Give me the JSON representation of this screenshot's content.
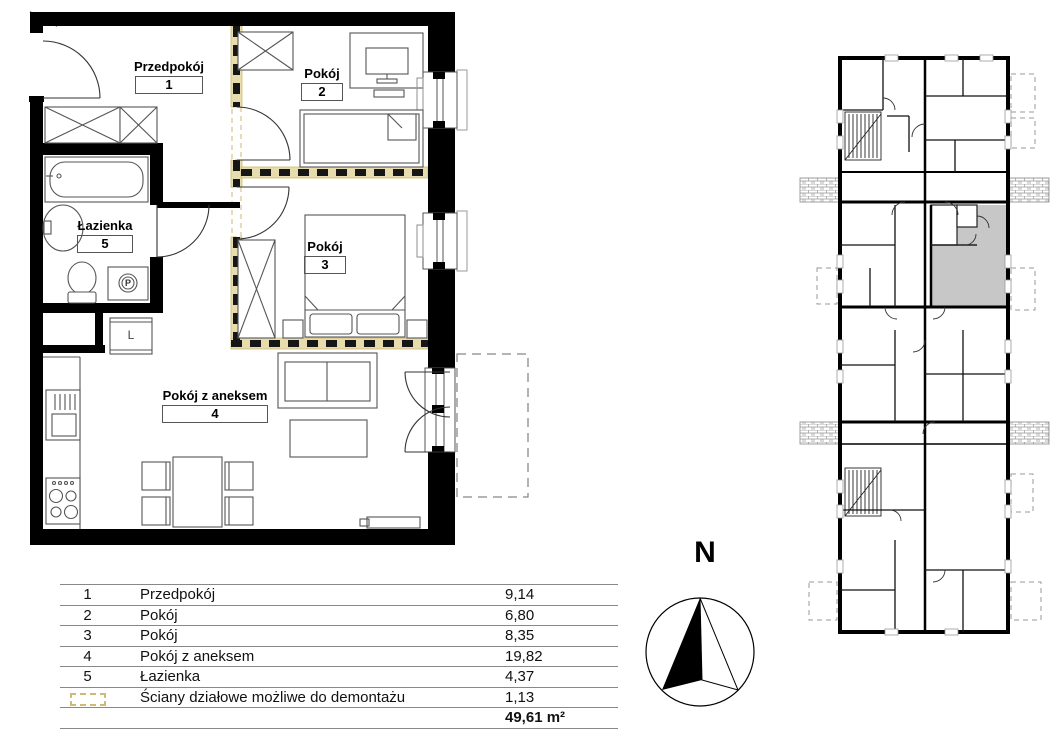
{
  "floor_plan": {
    "rooms": [
      {
        "id": "1",
        "name": "Przedpokój"
      },
      {
        "id": "2",
        "name": "Pokój"
      },
      {
        "id": "3",
        "name": "Pokój"
      },
      {
        "id": "4",
        "name": "Pokój z aneksem"
      },
      {
        "id": "5",
        "name": "Łazienka"
      }
    ],
    "labels": {
      "washer": "P",
      "closet": "L"
    }
  },
  "legend_table": {
    "rows": [
      {
        "no": "1",
        "name": "Przedpokój",
        "area": "9,14"
      },
      {
        "no": "2",
        "name": "Pokój",
        "area": "6,80"
      },
      {
        "no": "3",
        "name": "Pokój",
        "area": "8,35"
      },
      {
        "no": "4",
        "name": "Pokój z aneksem",
        "area": "19,82"
      },
      {
        "no": "5",
        "name": "Łazienka",
        "area": "4,37"
      },
      {
        "no": "",
        "name": "Ściany działowe możliwe do demontażu",
        "area": "1,13"
      }
    ],
    "total": "49,61 m²"
  },
  "compass": {
    "north_label": "N"
  },
  "colors": {
    "wall": "#000000",
    "demountable_fill": "#e7dcae",
    "demountable_edge": "#cdbb72",
    "unit_highlight": "#c7c7c7"
  }
}
